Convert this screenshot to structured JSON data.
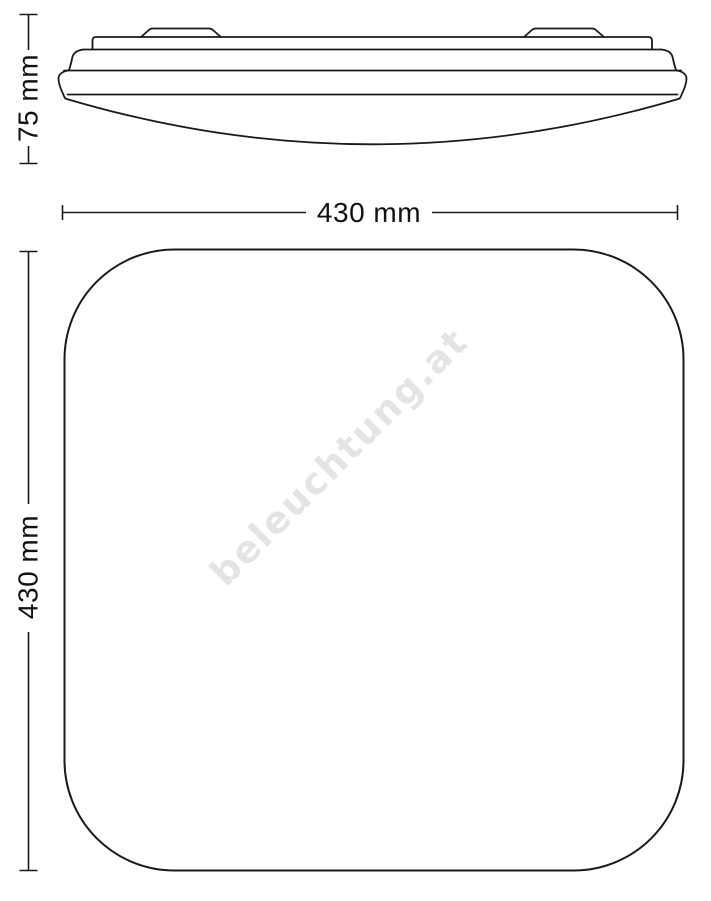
{
  "diagram": {
    "side_view": {
      "height_dimension": {
        "label": "75 mm"
      }
    },
    "front_view": {
      "width_dimension": {
        "label": "430 mm"
      },
      "height_dimension": {
        "label": "430 mm"
      }
    },
    "watermark": {
      "text": "beleuchtung.at",
      "color": "#e4e4e4"
    },
    "colors": {
      "line": "#1a1a1a",
      "text": "#111111",
      "fill": "#ffffff"
    }
  }
}
